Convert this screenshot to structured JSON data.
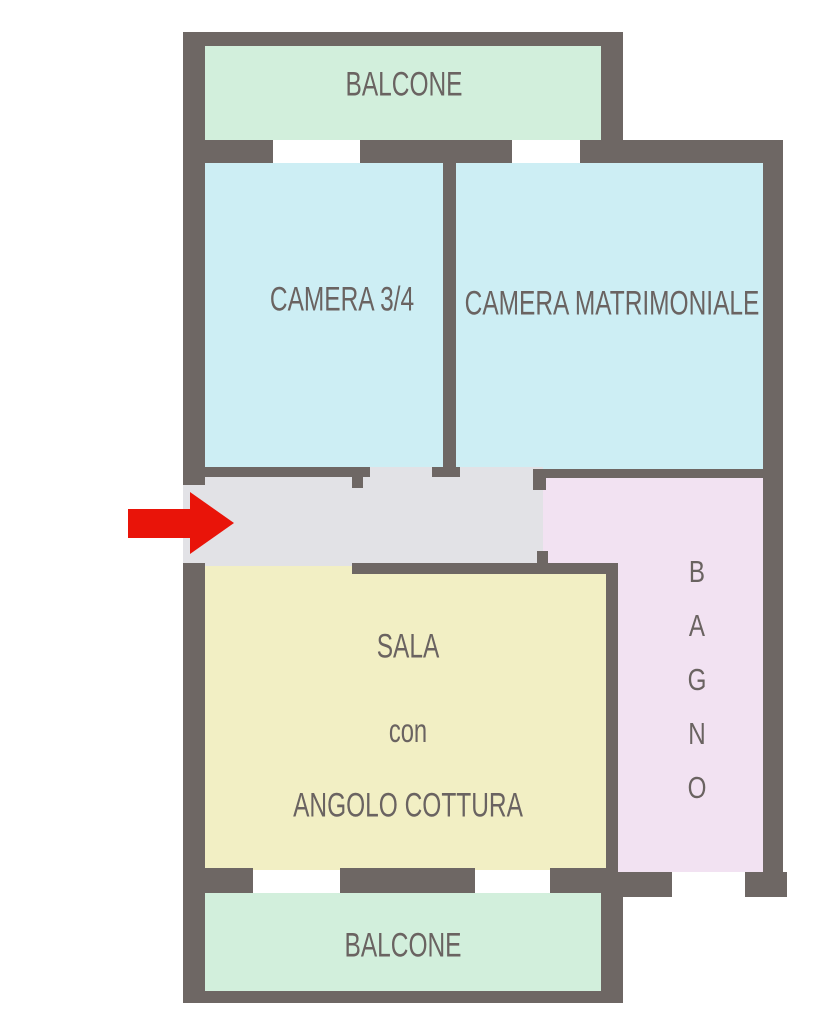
{
  "plan": {
    "type": "apartment-floor-plan",
    "rooms": {
      "balcone_top": {
        "label": "BALCONE",
        "fill": "#d2efdc"
      },
      "camera34": {
        "label": "CAMERA 3/4",
        "fill": "#cdeef4"
      },
      "camera_matrimoniale": {
        "label": "CAMERA MATRIMONIALE",
        "fill": "#cdeef4"
      },
      "corridoio": {
        "label": "",
        "fill": "#e2e2e6"
      },
      "bagno": {
        "label": "BAGNO",
        "letters": [
          "B",
          "A",
          "G",
          "N",
          "O"
        ],
        "orientation": "vertical",
        "fill": "#f2e2f2"
      },
      "sala": {
        "label_line1": "SALA",
        "label_line2": "con",
        "label_line3": "ANGOLO COTTURA",
        "fill": "#f2efc4"
      },
      "balcone_bottom": {
        "label": "BALCONE",
        "fill": "#d2efdc"
      }
    },
    "annotations": {
      "entrance_arrow": {
        "meaning": "entrance",
        "color": "#e91409",
        "direction": "right"
      }
    },
    "colors": {
      "wall": "#6e6764",
      "text": "#6a6361",
      "background": "#ffffff"
    }
  }
}
